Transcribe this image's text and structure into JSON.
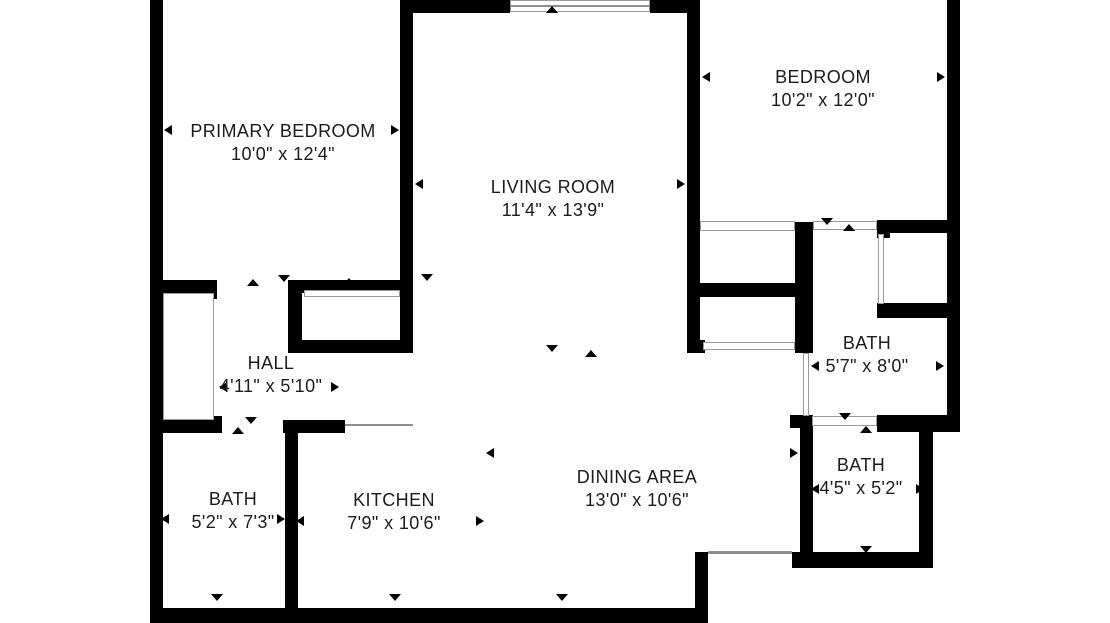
{
  "title": "Apartment floor plan",
  "floorplan": {
    "canvas": {
      "width": 1110,
      "height": 623
    },
    "wall_color": "#000000",
    "background_color": "#ffffff",
    "rooms": [
      {
        "id": "primary-bedroom",
        "name": "PRIMARY BEDROOM",
        "dims": "10'0\" x 12'4\"",
        "cx": 283,
        "top": 120
      },
      {
        "id": "bedroom",
        "name": "BEDROOM",
        "dims": "10'2\" x 12'0\"",
        "cx": 823,
        "top": 66
      },
      {
        "id": "living-room",
        "name": "LIVING ROOM",
        "dims": "11'4\" x 13'9\"",
        "cx": 553,
        "top": 176
      },
      {
        "id": "hall",
        "name": "HALL",
        "dims": "4'11\" x 5'10\"",
        "cx": 271,
        "top": 352
      },
      {
        "id": "bath-1",
        "name": "BATH",
        "dims": "5'2\" x 7'3\"",
        "cx": 233,
        "top": 488
      },
      {
        "id": "kitchen",
        "name": "KITCHEN",
        "dims": "7'9\" x 10'6\"",
        "cx": 394,
        "top": 489
      },
      {
        "id": "dining-area",
        "name": "DINING AREA",
        "dims": "13'0\" x 10'6\"",
        "cx": 637,
        "top": 466
      },
      {
        "id": "bath-2",
        "name": "BATH",
        "dims": "5'7\" x 8'0\"",
        "cx": 867,
        "top": 332
      },
      {
        "id": "bath-3",
        "name": "BATH",
        "dims": "4'5\" x 5'2\"",
        "cx": 861,
        "top": 454
      }
    ],
    "walls": [
      {
        "x": 150,
        "y": 0,
        "w": 13,
        "h": 623
      },
      {
        "x": 150,
        "y": 608,
        "w": 558,
        "h": 15
      },
      {
        "x": 695,
        "y": 552,
        "w": 13,
        "h": 60
      },
      {
        "x": 792,
        "y": 552,
        "w": 141,
        "h": 16
      },
      {
        "x": 919,
        "y": 427,
        "w": 14,
        "h": 129
      },
      {
        "x": 877,
        "y": 415,
        "w": 83,
        "h": 17
      },
      {
        "x": 947,
        "y": 0,
        "w": 13,
        "h": 431
      },
      {
        "x": 400,
        "y": 0,
        "w": 110,
        "h": 13
      },
      {
        "x": 650,
        "y": 0,
        "w": 50,
        "h": 13
      },
      {
        "x": 400,
        "y": 0,
        "w": 13,
        "h": 353
      },
      {
        "x": 687,
        "y": 0,
        "w": 13,
        "h": 353
      },
      {
        "x": 150,
        "y": 280,
        "w": 67,
        "h": 14
      },
      {
        "x": 203,
        "y": 280,
        "w": 14,
        "h": 19
      },
      {
        "x": 288,
        "y": 280,
        "w": 125,
        "h": 13
      },
      {
        "x": 288,
        "y": 280,
        "w": 14,
        "h": 73
      },
      {
        "x": 288,
        "y": 340,
        "w": 125,
        "h": 13
      },
      {
        "x": 150,
        "y": 420,
        "w": 72,
        "h": 13
      },
      {
        "x": 203,
        "y": 416,
        "w": 19,
        "h": 17
      },
      {
        "x": 283,
        "y": 420,
        "w": 62,
        "h": 13
      },
      {
        "x": 285,
        "y": 420,
        "w": 13,
        "h": 190
      },
      {
        "x": 795,
        "y": 222,
        "w": 18,
        "h": 131
      },
      {
        "x": 687,
        "y": 283,
        "w": 126,
        "h": 14
      },
      {
        "x": 687,
        "y": 340,
        "w": 18,
        "h": 13
      },
      {
        "x": 877,
        "y": 220,
        "w": 83,
        "h": 13
      },
      {
        "x": 877,
        "y": 303,
        "w": 70,
        "h": 15
      },
      {
        "x": 877,
        "y": 220,
        "w": 13,
        "h": 18
      },
      {
        "x": 800,
        "y": 415,
        "w": 13,
        "h": 140
      },
      {
        "x": 790,
        "y": 415,
        "w": 13,
        "h": 13
      }
    ],
    "thin_features": [
      {
        "type": "box",
        "x": 510,
        "y": 0,
        "w": 140,
        "h": 12,
        "label": "top-window"
      },
      {
        "type": "line",
        "x": 510,
        "y": 5,
        "w": 140,
        "h": 2,
        "label": "top-window-glass"
      },
      {
        "type": "box",
        "x": 304,
        "y": 290,
        "w": 96,
        "h": 7,
        "label": "primary-closet-doors"
      },
      {
        "type": "box",
        "x": 163,
        "y": 293,
        "w": 51,
        "h": 127,
        "label": "hall-closet"
      },
      {
        "type": "box",
        "x": 700,
        "y": 221,
        "w": 95,
        "h": 10,
        "label": "bedroom-closet-doors"
      },
      {
        "type": "box",
        "x": 703,
        "y": 342,
        "w": 92,
        "h": 8,
        "label": "hall-closet-doors"
      },
      {
        "type": "box",
        "x": 878,
        "y": 234,
        "w": 6,
        "h": 70,
        "label": "shower-glass"
      },
      {
        "type": "box",
        "x": 813,
        "y": 221,
        "w": 64,
        "h": 9,
        "label": "bath-door-opening"
      },
      {
        "type": "box",
        "x": 803,
        "y": 353,
        "w": 6,
        "h": 63,
        "label": "bath-pocket-door"
      },
      {
        "type": "box",
        "x": 812,
        "y": 416,
        "w": 65,
        "h": 10,
        "label": "bath-door-opening"
      },
      {
        "type": "line",
        "x": 708,
        "y": 551,
        "w": 84,
        "h": 3,
        "label": "patio-slider"
      },
      {
        "type": "line",
        "x": 345,
        "y": 424,
        "w": 68,
        "h": 2,
        "label": "counter-line"
      }
    ],
    "markers": [
      {
        "x": 552,
        "y": 9,
        "dir": "up",
        "kind": "opening"
      },
      {
        "x": 253,
        "y": 282,
        "dir": "up",
        "kind": "opening"
      },
      {
        "x": 284,
        "y": 278,
        "dir": "down",
        "kind": "opening"
      },
      {
        "x": 349,
        "y": 281,
        "dir": "up",
        "kind": "opening"
      },
      {
        "x": 427,
        "y": 277,
        "dir": "down",
        "kind": "opening"
      },
      {
        "x": 238,
        "y": 430,
        "dir": "up",
        "kind": "opening"
      },
      {
        "x": 251,
        "y": 420,
        "dir": "down",
        "kind": "opening"
      },
      {
        "x": 217,
        "y": 597,
        "dir": "down",
        "kind": "opening"
      },
      {
        "x": 395,
        "y": 597,
        "dir": "down",
        "kind": "opening"
      },
      {
        "x": 562,
        "y": 597,
        "dir": "down",
        "kind": "opening"
      },
      {
        "x": 552,
        "y": 348,
        "dir": "down",
        "kind": "opening"
      },
      {
        "x": 591,
        "y": 353,
        "dir": "up",
        "kind": "opening"
      },
      {
        "x": 827,
        "y": 221,
        "dir": "down",
        "kind": "opening"
      },
      {
        "x": 849,
        "y": 227,
        "dir": "up",
        "kind": "opening"
      },
      {
        "x": 845,
        "y": 416,
        "dir": "down",
        "kind": "opening"
      },
      {
        "x": 866,
        "y": 429,
        "dir": "up",
        "kind": "opening"
      },
      {
        "x": 866,
        "y": 549,
        "dir": "down",
        "kind": "opening"
      },
      {
        "x": 168,
        "y": 130,
        "dir": "left",
        "kind": "dimension"
      },
      {
        "x": 395,
        "y": 130,
        "dir": "right",
        "kind": "dimension"
      },
      {
        "x": 706,
        "y": 77,
        "dir": "left",
        "kind": "dimension"
      },
      {
        "x": 941,
        "y": 77,
        "dir": "right",
        "kind": "dimension"
      },
      {
        "x": 419,
        "y": 184,
        "dir": "left",
        "kind": "dimension"
      },
      {
        "x": 681,
        "y": 184,
        "dir": "right",
        "kind": "dimension"
      },
      {
        "x": 223,
        "y": 387,
        "dir": "left",
        "kind": "dimension"
      },
      {
        "x": 335,
        "y": 387,
        "dir": "right",
        "kind": "dimension"
      },
      {
        "x": 165,
        "y": 519,
        "dir": "left",
        "kind": "dimension"
      },
      {
        "x": 281,
        "y": 519,
        "dir": "right",
        "kind": "dimension"
      },
      {
        "x": 300,
        "y": 521,
        "dir": "left",
        "kind": "dimension"
      },
      {
        "x": 480,
        "y": 521,
        "dir": "right",
        "kind": "dimension"
      },
      {
        "x": 490,
        "y": 453,
        "dir": "left",
        "kind": "dimension"
      },
      {
        "x": 794,
        "y": 453,
        "dir": "right",
        "kind": "dimension"
      },
      {
        "x": 815,
        "y": 366,
        "dir": "left",
        "kind": "dimension"
      },
      {
        "x": 940,
        "y": 366,
        "dir": "right",
        "kind": "dimension"
      },
      {
        "x": 815,
        "y": 489,
        "dir": "left",
        "kind": "dimension"
      },
      {
        "x": 920,
        "y": 489,
        "dir": "right",
        "kind": "dimension"
      }
    ]
  }
}
